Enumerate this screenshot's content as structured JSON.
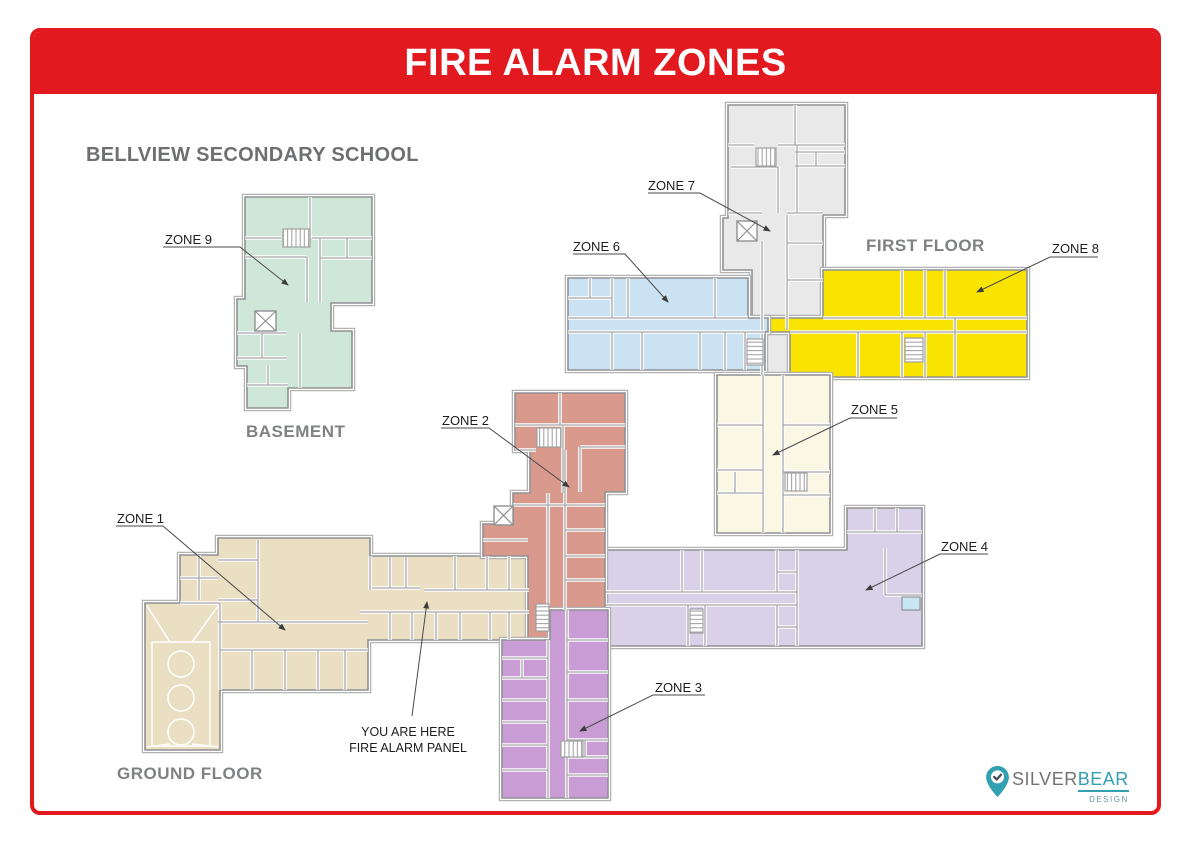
{
  "page": {
    "title": "FIRE ALARM ZONES",
    "school": "BELLVIEW SECONDARY SCHOOL",
    "accent_red": "#e2191f"
  },
  "floors": {
    "basement": "BASEMENT",
    "first": "FIRST FLOOR",
    "ground": "GROUND FLOOR"
  },
  "zones": {
    "z1": {
      "label": "ZONE 1",
      "color": "#eadfc3"
    },
    "z2": {
      "label": "ZONE 2",
      "color": "#d9998d"
    },
    "z3": {
      "label": "ZONE 3",
      "color": "#c99cd5"
    },
    "z4": {
      "label": "ZONE 4",
      "color": "#d9d1e8"
    },
    "z5": {
      "label": "ZONE 5",
      "color": "#faf7e4"
    },
    "z6": {
      "label": "ZONE 6",
      "color": "#cbe2f2"
    },
    "z7": {
      "label": "ZONE 7",
      "color": "#e9e9ea"
    },
    "z8": {
      "label": "ZONE 8",
      "color": "#f9e300"
    },
    "z9": {
      "label": "ZONE 9",
      "color": "#cee7d8"
    }
  },
  "annotations": {
    "you_are_here_line1": "YOU ARE HERE",
    "you_are_here_line2": "FIRE ALARM PANEL"
  },
  "misc": {
    "pool_color": "#c9e6f5"
  },
  "logo": {
    "part1": "SILVER",
    "part2": "BEAR",
    "part3": "DESIGN",
    "teal": "#33a0b2"
  }
}
